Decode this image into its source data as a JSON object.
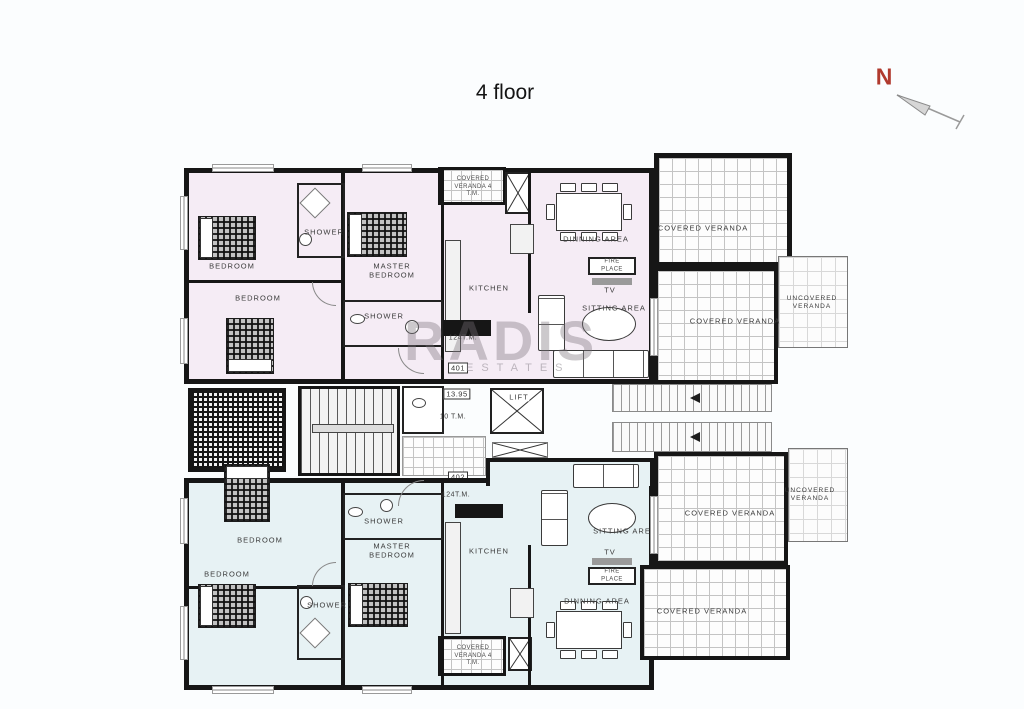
{
  "title": "4 floor",
  "compass": {
    "label": "N"
  },
  "watermark": {
    "name": "RADIS",
    "subtitle": "ESTATES"
  },
  "core": {
    "lift": "LIFT",
    "level": "13.95",
    "landing_area": "10 T.M.",
    "unit_top_number": "401",
    "unit_bottom_number": "402"
  },
  "unit_top": {
    "area": "124T.M.",
    "bedroom_a": "BEDROOM",
    "bedroom_b": "BEDROOM",
    "master_bedroom": "MASTER BEDROOM",
    "shower_a": "SHOWER",
    "shower_b": "SHOWER",
    "kitchen": "KITCHEN",
    "dinning_area": "DINNING AREA",
    "sitting_area": "SITTING AREA",
    "tv": "TV",
    "fire_place": "FIRE PLACE",
    "veranda_strip": "COVERED VERANDA 4 T.M.",
    "covered_veranda_top": "COVERED VERANDA",
    "covered_veranda_right": "COVERED VERANDA",
    "uncovered_veranda": "UNCOVERED VERANDA"
  },
  "unit_bottom": {
    "area": "124T.M.",
    "bedroom_a": "BEDROOM",
    "bedroom_b": "BEDROOM",
    "master_bedroom": "MASTER BEDROOM",
    "shower_a": "SHOWER",
    "shower_b": "SHOWER",
    "kitchen": "KITCHEN",
    "dinning_area": "DINNING AREA",
    "sitting_area": "SITTING AREA",
    "tv": "TV",
    "fire_place": "FIRE PLACE",
    "veranda_strip": "COVERED VERANDA 4 T.M.",
    "covered_veranda_right": "COVERED VERANDA",
    "covered_veranda_bottom": "COVERED VERANDA",
    "uncovered_veranda": "UNCOVERED VERANDA"
  }
}
